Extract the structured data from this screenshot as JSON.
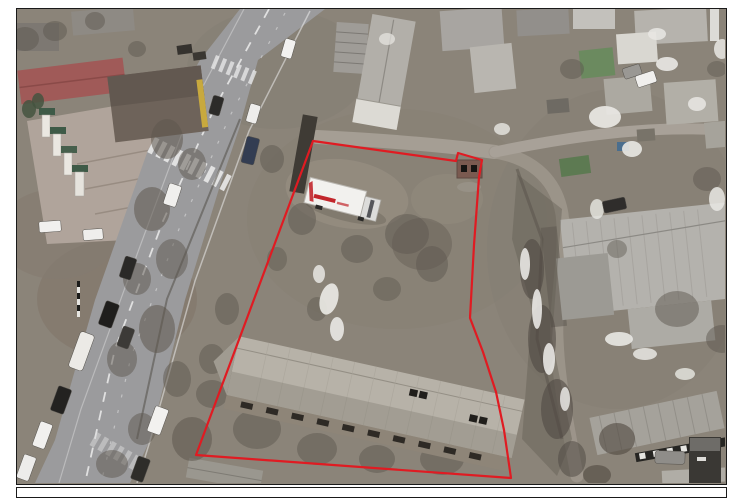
{
  "page": {
    "background_color": "#ffffff"
  },
  "photo_frame": {
    "border_color": "#1a1a1a",
    "caption_text": ""
  },
  "annotation": {
    "label": "land-plot-boundary",
    "outline_color": "#e01b22",
    "outline_points": "296,132 439,152 441,144 465,151 462,168 457,236 453,309 466,343 479,383 487,421 494,469 179,446"
  },
  "scene": {
    "description": "Aerial drone photo of an urban land plot outlined in red: dirt lot with a white box truck, an abandoned two-storey building, bare winter trees, a main road with cars and crosswalks on the left, residential courtyards with snow patches on the right",
    "ground_color": "#8b8479",
    "road_color": "#9b9b9d",
    "plaza_color": "#b0a49b",
    "snow_color": "#e9e8e4",
    "tree_color": "#5e584f",
    "roof_color": "#b7b2a8",
    "red_roof_color": "#a05a58",
    "truck_brand_color": "#c2262b"
  }
}
